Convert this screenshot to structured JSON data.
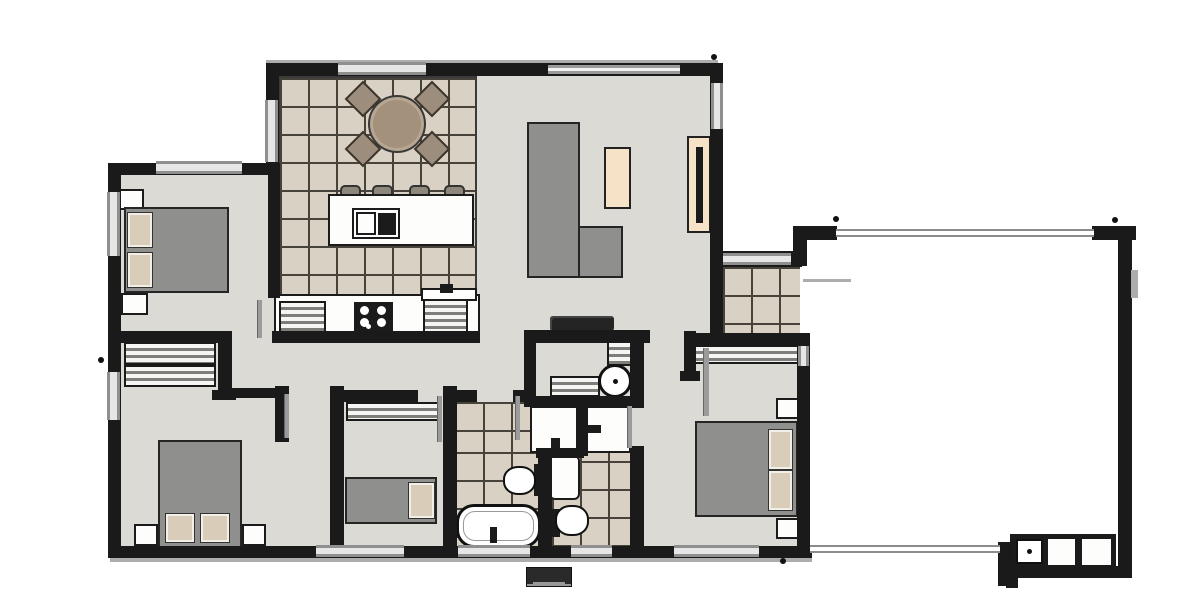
{
  "meta": {
    "title": "house-floor-plan",
    "canvas": {
      "width": 1200,
      "height": 597
    }
  },
  "palette": {
    "wall": "#1a1a1a",
    "floor": "#dbdad5",
    "tile": "#d8d1c4",
    "tileline": "#47423a",
    "furn": "#8f8f8d",
    "pillow": "#d9cdb9",
    "cream": "#f6e2c7",
    "chair": "#9d8d7d",
    "table": "#a3917c"
  },
  "elements": [
    {
      "t": "floor",
      "n": "living-kitchen-floor",
      "x": 276,
      "y": 74,
      "w": 436,
      "h": 262
    },
    {
      "t": "floor",
      "n": "bedroom1-floor",
      "x": 116,
      "y": 170,
      "w": 160,
      "h": 168
    },
    {
      "t": "floor",
      "n": "south-wing-floor",
      "x": 116,
      "y": 336,
      "w": 692,
      "h": 216
    },
    {
      "t": "tile",
      "n": "kitchen-dining-tiles",
      "x": 278,
      "y": 76,
      "w": 199,
      "h": 222,
      "c": "edge"
    },
    {
      "t": "tile",
      "n": "entry-porch-tiles",
      "x": 723,
      "y": 267,
      "w": 77,
      "h": 68
    },
    {
      "t": "tile",
      "n": "bathroom-tiles-upper",
      "x": 455,
      "y": 402,
      "w": 123,
      "h": 50
    },
    {
      "t": "tile",
      "n": "bathroom-tiles-lower",
      "x": 455,
      "y": 452,
      "w": 85,
      "h": 96
    },
    {
      "t": "tile",
      "n": "ensuite-tiles",
      "x": 552,
      "y": 405,
      "w": 80,
      "h": 143
    },
    {
      "t": "gray-line",
      "n": "eave-line-top",
      "x": 266,
      "y": 60,
      "w": 452,
      "h": 3
    },
    {
      "t": "white-box",
      "n": "bed1-nightstand-top",
      "x": 119,
      "y": 189,
      "w": 25,
      "h": 21
    },
    {
      "t": "white-box",
      "n": "bed1-nightstand-bottom",
      "x": 121,
      "y": 293,
      "w": 27,
      "h": 22
    },
    {
      "t": "furn",
      "n": "bed1-bed",
      "x": 124,
      "y": 207,
      "w": 105,
      "h": 86
    },
    {
      "t": "pillow",
      "n": "bed1-pillow-1",
      "x": 128,
      "y": 213,
      "w": 24,
      "h": 34
    },
    {
      "t": "pillow",
      "n": "bed1-pillow-2",
      "x": 128,
      "y": 253,
      "w": 24,
      "h": 34
    },
    {
      "t": "robe",
      "n": "hall-robe-upper",
      "x": 124,
      "y": 342,
      "w": 92,
      "h": 23
    },
    {
      "t": "robe",
      "n": "hall-robe-lower",
      "x": 124,
      "y": 365,
      "w": 92,
      "h": 22
    },
    {
      "t": "furn",
      "n": "bed2-bed",
      "x": 158,
      "y": 440,
      "w": 84,
      "h": 108
    },
    {
      "t": "pillow",
      "n": "bed2-pillow-1",
      "x": 166,
      "y": 514,
      "w": 28,
      "h": 28
    },
    {
      "t": "pillow",
      "n": "bed2-pillow-2",
      "x": 201,
      "y": 514,
      "w": 28,
      "h": 28
    },
    {
      "t": "white-box",
      "n": "bed2-nightstand-left",
      "x": 134,
      "y": 524,
      "w": 24,
      "h": 22
    },
    {
      "t": "white-box",
      "n": "bed2-nightstand-right",
      "x": 242,
      "y": 524,
      "w": 24,
      "h": 22
    },
    {
      "t": "robe",
      "n": "bed3-robe",
      "x": 346,
      "y": 402,
      "w": 96,
      "h": 19
    },
    {
      "t": "furn",
      "n": "bed3-bed",
      "x": 345,
      "y": 477,
      "w": 92,
      "h": 47
    },
    {
      "t": "pillow",
      "n": "bed3-pillow",
      "x": 409,
      "y": 483,
      "w": 25,
      "h": 35
    },
    {
      "t": "robe",
      "n": "master-robe",
      "x": 694,
      "y": 345,
      "w": 108,
      "h": 19
    },
    {
      "t": "white-box",
      "n": "master-nightstand-top",
      "x": 776,
      "y": 398,
      "w": 25,
      "h": 21
    },
    {
      "t": "white-box",
      "n": "master-nightstand-bottom",
      "x": 776,
      "y": 518,
      "w": 25,
      "h": 21
    },
    {
      "t": "furn",
      "n": "master-bed",
      "x": 695,
      "y": 421,
      "w": 103,
      "h": 96
    },
    {
      "t": "pillow",
      "n": "master-pillow-1",
      "x": 769,
      "y": 430,
      "w": 23,
      "h": 39
    },
    {
      "t": "pillow",
      "n": "master-pillow-2",
      "x": 769,
      "y": 471,
      "w": 23,
      "h": 39
    },
    {
      "t": "furn",
      "n": "sofa-main",
      "x": 527,
      "y": 122,
      "w": 53,
      "h": 156
    },
    {
      "t": "furn",
      "n": "sofa-chaise",
      "x": 578,
      "y": 226,
      "w": 45,
      "h": 52
    },
    {
      "t": "cream",
      "n": "coffee-table",
      "x": 604,
      "y": 147,
      "w": 27,
      "h": 62
    },
    {
      "t": "cream",
      "n": "tv-cabinet",
      "x": 687,
      "y": 136,
      "w": 24,
      "h": 97
    },
    {
      "t": "dark-box",
      "n": "tv",
      "x": 696,
      "y": 147,
      "w": 7,
      "h": 76
    },
    {
      "t": "white-box",
      "n": "kitchen-counter",
      "x": 274,
      "y": 294,
      "w": 206,
      "h": 44
    },
    {
      "t": "robe",
      "n": "kitchen-cabinet-left",
      "x": 279,
      "y": 301,
      "w": 47,
      "h": 32
    },
    {
      "t": "dark-box",
      "n": "cooktop",
      "x": 354,
      "y": 302,
      "w": 39,
      "h": 31
    },
    {
      "t": "burner",
      "n": "burner-1",
      "x": 360,
      "y": 306,
      "w": 9,
      "h": 9
    },
    {
      "t": "burner",
      "n": "burner-2",
      "x": 377,
      "y": 306,
      "w": 9,
      "h": 9
    },
    {
      "t": "burner",
      "n": "burner-3",
      "x": 360,
      "y": 318,
      "w": 9,
      "h": 9
    },
    {
      "t": "burner",
      "n": "burner-4",
      "x": 377,
      "y": 318,
      "w": 9,
      "h": 9
    },
    {
      "t": "burner",
      "n": "burner-5",
      "x": 366,
      "y": 324,
      "w": 5,
      "h": 5
    },
    {
      "t": "robe",
      "n": "kitchen-cabinet-right",
      "x": 423,
      "y": 299,
      "w": 45,
      "h": 34
    },
    {
      "t": "white-box",
      "n": "kitchen-sink-bench",
      "x": 421,
      "y": 288,
      "w": 56,
      "h": 13
    },
    {
      "t": "dark-box",
      "n": "kitchen-tap",
      "x": 440,
      "y": 284,
      "w": 13,
      "h": 9
    },
    {
      "t": "stool",
      "n": "stool-1",
      "x": 340,
      "y": 185,
      "w": 21,
      "h": 13
    },
    {
      "t": "stool",
      "n": "stool-2",
      "x": 372,
      "y": 185,
      "w": 21,
      "h": 13
    },
    {
      "t": "stool",
      "n": "stool-3",
      "x": 409,
      "y": 185,
      "w": 21,
      "h": 13
    },
    {
      "t": "stool",
      "n": "stool-4",
      "x": 444,
      "y": 185,
      "w": 21,
      "h": 13
    },
    {
      "t": "white-box",
      "n": "island-bench",
      "x": 328,
      "y": 194,
      "w": 146,
      "h": 52
    },
    {
      "t": "white-box",
      "n": "island-sink",
      "x": 352,
      "y": 208,
      "w": 48,
      "h": 31
    },
    {
      "t": "white-box",
      "n": "island-sink-basin",
      "x": 356,
      "y": 212,
      "w": 20,
      "h": 23
    },
    {
      "t": "dark-box",
      "n": "island-sink-drainer",
      "x": 378,
      "y": 213,
      "w": 18,
      "h": 22
    },
    {
      "t": "chair",
      "n": "dining-chair-nw",
      "x": 350,
      "y": 86,
      "w": 26,
      "h": 26
    },
    {
      "t": "chair",
      "n": "dining-chair-ne",
      "x": 419,
      "y": 86,
      "w": 26,
      "h": 26
    },
    {
      "t": "chair",
      "n": "dining-chair-sw",
      "x": 350,
      "y": 136,
      "w": 26,
      "h": 26
    },
    {
      "t": "chair",
      "n": "dining-chair-se",
      "x": 419,
      "y": 136,
      "w": 26,
      "h": 26
    },
    {
      "t": "table-round",
      "n": "dining-table",
      "x": 368,
      "y": 95,
      "w": 58,
      "h": 58
    },
    {
      "t": "benchdark",
      "n": "laundry-appliance",
      "x": 550,
      "y": 316,
      "w": 64,
      "h": 15
    },
    {
      "t": "robe",
      "n": "laundry-shelf",
      "x": 550,
      "y": 376,
      "w": 50,
      "h": 21
    },
    {
      "t": "robe",
      "n": "laundry-pantry",
      "x": 607,
      "y": 341,
      "w": 25,
      "h": 25
    },
    {
      "t": "washer",
      "n": "washing-machine",
      "x": 598,
      "y": 364,
      "w": 34,
      "h": 34
    },
    {
      "t": "white-box",
      "n": "bath-vanity",
      "x": 530,
      "y": 406,
      "w": 49,
      "h": 47
    },
    {
      "t": "dark-box",
      "n": "bath-vanity-tap",
      "x": 551,
      "y": 438,
      "w": 9,
      "h": 13
    },
    {
      "t": "dark-box",
      "n": "bath-toilet-tank",
      "x": 534,
      "y": 464,
      "w": 14,
      "h": 32
    },
    {
      "t": "toilet",
      "n": "bath-toilet",
      "x": 503,
      "y": 466,
      "w": 33,
      "h": 29
    },
    {
      "t": "tub",
      "n": "bathtub",
      "x": 456,
      "y": 504,
      "w": 85,
      "h": 44
    },
    {
      "t": "dark-box",
      "n": "bathtub-tap",
      "x": 490,
      "y": 527,
      "w": 7,
      "h": 16
    },
    {
      "t": "white-box",
      "n": "ensuite-vanity",
      "x": 584,
      "y": 406,
      "w": 47,
      "h": 47
    },
    {
      "t": "dark-box",
      "n": "ensuite-vanity-tap",
      "x": 586,
      "y": 425,
      "w": 15,
      "h": 8
    },
    {
      "t": "white-box",
      "n": "shower",
      "x": 549,
      "y": 455,
      "w": 31,
      "h": 45,
      "c": "rnd"
    },
    {
      "t": "dark-box",
      "n": "shower-fixture",
      "x": 541,
      "y": 470,
      "w": 8,
      "h": 16
    },
    {
      "t": "dark-box",
      "n": "ensuite-toilet-tank",
      "x": 548,
      "y": 509,
      "w": 12,
      "h": 28
    },
    {
      "t": "toilet",
      "n": "ensuite-toilet",
      "x": 555,
      "y": 505,
      "w": 34,
      "h": 31
    },
    {
      "t": "dark-box",
      "n": "garage-bench-base",
      "x": 1010,
      "y": 534,
      "w": 106,
      "h": 36
    },
    {
      "t": "sinkbox",
      "n": "garage-sink",
      "x": 1016,
      "y": 539,
      "w": 27,
      "h": 25
    },
    {
      "t": "white-box",
      "n": "garage-bench-1",
      "x": 1046,
      "y": 537,
      "w": 31,
      "h": 30
    },
    {
      "t": "white-box",
      "n": "garage-bench-2",
      "x": 1080,
      "y": 537,
      "w": 33,
      "h": 30
    },
    {
      "t": "meter",
      "n": "meter-box",
      "x": 526,
      "y": 567,
      "w": 46,
      "h": 20
    },
    {
      "t": "wall",
      "n": "wall-dining-top",
      "x": 266,
      "y": 63,
      "w": 212,
      "h": 13
    },
    {
      "t": "wall",
      "n": "wall-dining-left",
      "x": 266,
      "y": 63,
      "w": 13,
      "h": 110
    },
    {
      "t": "wall",
      "n": "wall-bed1-top",
      "x": 108,
      "y": 163,
      "w": 172,
      "h": 12
    },
    {
      "t": "wall",
      "n": "wall-exterior-left",
      "x": 108,
      "y": 163,
      "w": 13,
      "h": 395
    },
    {
      "t": "wall",
      "n": "wall-exterior-bottom",
      "x": 108,
      "y": 546,
      "w": 704,
      "h": 12
    },
    {
      "t": "wall",
      "n": "wall-master-east",
      "x": 797,
      "y": 335,
      "w": 13,
      "h": 223
    },
    {
      "t": "wall",
      "n": "wall-master-top",
      "x": 686,
      "y": 333,
      "w": 124,
      "h": 13
    },
    {
      "t": "wall",
      "n": "wall-living-right",
      "x": 710,
      "y": 63,
      "w": 13,
      "h": 279
    },
    {
      "t": "wall",
      "n": "wall-entry",
      "x": 710,
      "y": 251,
      "w": 92,
      "h": 16
    },
    {
      "t": "wall",
      "n": "wall-living-top",
      "x": 476,
      "y": 63,
      "w": 246,
      "h": 13
    },
    {
      "t": "wall",
      "n": "wall-bed1-east",
      "x": 268,
      "y": 173,
      "w": 12,
      "h": 125
    },
    {
      "t": "wall",
      "n": "wall-bed1-bottom",
      "x": 116,
      "y": 331,
      "w": 116,
      "h": 12
    },
    {
      "t": "wall",
      "n": "wall-nook-east",
      "x": 218,
      "y": 331,
      "w": 14,
      "h": 63
    },
    {
      "t": "wall",
      "n": "wall-nook-cap",
      "x": 212,
      "y": 390,
      "w": 24,
      "h": 10
    },
    {
      "t": "wall",
      "n": "wall-kitchen-bottom",
      "x": 272,
      "y": 331,
      "w": 208,
      "h": 12
    },
    {
      "t": "wall",
      "n": "wall-bed2-top",
      "x": 232,
      "y": 388,
      "w": 57,
      "h": 10
    },
    {
      "t": "wall",
      "n": "wall-bed2-stub",
      "x": 275,
      "y": 386,
      "w": 14,
      "h": 56
    },
    {
      "t": "wall",
      "n": "wall-bed3-west",
      "x": 330,
      "y": 386,
      "w": 14,
      "h": 166
    },
    {
      "t": "wall",
      "n": "wall-bed3-north",
      "x": 330,
      "y": 390,
      "w": 88,
      "h": 12
    },
    {
      "t": "wall",
      "n": "wall-bed3-east",
      "x": 443,
      "y": 386,
      "w": 14,
      "h": 166
    },
    {
      "t": "wall",
      "n": "wall-bath-north-left",
      "x": 455,
      "y": 390,
      "w": 22,
      "h": 12
    },
    {
      "t": "wall",
      "n": "wall-bath-north-right",
      "x": 513,
      "y": 390,
      "w": 23,
      "h": 12
    },
    {
      "t": "wall",
      "n": "wall-hall-laundry",
      "x": 524,
      "y": 330,
      "w": 12,
      "h": 74
    },
    {
      "t": "wall",
      "n": "wall-living-bottom",
      "x": 524,
      "y": 330,
      "w": 126,
      "h": 13
    },
    {
      "t": "wall",
      "n": "wall-laundry-south",
      "x": 524,
      "y": 396,
      "w": 120,
      "h": 11
    },
    {
      "t": "wall",
      "n": "wall-vanity-divider",
      "x": 576,
      "y": 398,
      "w": 12,
      "h": 58
    },
    {
      "t": "wall",
      "n": "wall-bath-mid",
      "x": 536,
      "y": 448,
      "w": 48,
      "h": 10
    },
    {
      "t": "wall",
      "n": "wall-bath-ensuite",
      "x": 538,
      "y": 452,
      "w": 14,
      "h": 96
    },
    {
      "t": "wall",
      "n": "wall-ensuite-east-upper",
      "x": 630,
      "y": 330,
      "w": 14,
      "h": 78
    },
    {
      "t": "wall",
      "n": "wall-ensuite-east-lower",
      "x": 630,
      "y": 446,
      "w": 14,
      "h": 106
    },
    {
      "t": "wall",
      "n": "wall-master-stub",
      "x": 684,
      "y": 331,
      "w": 12,
      "h": 48
    },
    {
      "t": "wall",
      "n": "cap-master-stub",
      "x": 680,
      "y": 371,
      "w": 20,
      "h": 10
    },
    {
      "t": "wall",
      "n": "garage-post-nw-a",
      "x": 793,
      "y": 226,
      "w": 44,
      "h": 14
    },
    {
      "t": "wall",
      "n": "garage-post-nw-b",
      "x": 793,
      "y": 226,
      "w": 14,
      "h": 40
    },
    {
      "t": "wall",
      "n": "garage-post-ne",
      "x": 1092,
      "y": 226,
      "w": 44,
      "h": 14
    },
    {
      "t": "wall",
      "n": "wall-garage-right",
      "x": 1118,
      "y": 226,
      "w": 14,
      "h": 352
    },
    {
      "t": "wall",
      "n": "wall-garage-bottom",
      "x": 1000,
      "y": 566,
      "w": 132,
      "h": 12
    },
    {
      "t": "wall",
      "n": "garage-door-post",
      "x": 998,
      "y": 542,
      "w": 14,
      "h": 44
    },
    {
      "t": "wall",
      "n": "garage-notch",
      "x": 1006,
      "y": 578,
      "w": 12,
      "h": 10
    },
    {
      "t": "window",
      "n": "window-dining-top",
      "x": 338,
      "y": 62,
      "w": 88,
      "h": 13
    },
    {
      "t": "window",
      "n": "window-dining-left",
      "x": 265,
      "y": 100,
      "w": 13,
      "h": 62,
      "c": "v"
    },
    {
      "t": "window",
      "n": "window-bed1-top",
      "x": 156,
      "y": 161,
      "w": 86,
      "h": 13
    },
    {
      "t": "window",
      "n": "window-bed1-left",
      "x": 107,
      "y": 192,
      "w": 13,
      "h": 64,
      "c": "v"
    },
    {
      "t": "window",
      "n": "window-bed2-left",
      "x": 107,
      "y": 372,
      "w": 13,
      "h": 48,
      "c": "v"
    },
    {
      "t": "window",
      "n": "window-bed3-bottom",
      "x": 316,
      "y": 545,
      "w": 88,
      "h": 12
    },
    {
      "t": "window",
      "n": "window-bath-bottom",
      "x": 458,
      "y": 545,
      "w": 72,
      "h": 12
    },
    {
      "t": "window",
      "n": "window-ensuite-bottom",
      "x": 571,
      "y": 545,
      "w": 41,
      "h": 12
    },
    {
      "t": "window",
      "n": "window-master-bottom",
      "x": 674,
      "y": 545,
      "w": 85,
      "h": 12
    },
    {
      "t": "window",
      "n": "window-living-right",
      "x": 711,
      "y": 83,
      "w": 12,
      "h": 46,
      "c": "v"
    },
    {
      "t": "window",
      "n": "window-master-east",
      "x": 798,
      "y": 346,
      "w": 11,
      "h": 20,
      "c": "v"
    },
    {
      "t": "glz",
      "n": "glazing-living-top",
      "x": 548,
      "y": 65,
      "w": 132,
      "h": 9
    },
    {
      "t": "window",
      "n": "entry-door",
      "x": 723,
      "y": 253,
      "w": 68,
      "h": 12
    },
    {
      "t": "dline",
      "n": "garage-roof-line",
      "x": 836,
      "y": 229,
      "w": 258,
      "h": 8
    },
    {
      "t": "dline",
      "n": "garage-door-track",
      "x": 810,
      "y": 545,
      "w": 190,
      "h": 8
    },
    {
      "t": "gray-line",
      "n": "garage-eave-line",
      "x": 803,
      "y": 279,
      "w": 48,
      "h": 3
    },
    {
      "t": "gray-line",
      "n": "garage-meter-bump",
      "x": 1131,
      "y": 270,
      "w": 7,
      "h": 28
    },
    {
      "t": "leaf",
      "n": "door-leaf-bed1",
      "x": 257,
      "y": 300,
      "w": 5,
      "h": 38
    },
    {
      "t": "leaf",
      "n": "door-leaf-bed2",
      "x": 284,
      "y": 394,
      "w": 5,
      "h": 44
    },
    {
      "t": "leaf",
      "n": "door-leaf-bed3",
      "x": 437,
      "y": 396,
      "w": 5,
      "h": 46
    },
    {
      "t": "leaf",
      "n": "door-leaf-bath",
      "x": 515,
      "y": 396,
      "w": 5,
      "h": 44
    },
    {
      "t": "leaf",
      "n": "door-leaf-ensuite",
      "x": 627,
      "y": 406,
      "w": 5,
      "h": 42
    },
    {
      "t": "leaf",
      "n": "door-leaf-master",
      "x": 703,
      "y": 348,
      "w": 6,
      "h": 68
    },
    {
      "t": "gray-line",
      "n": "shadow-bottom",
      "x": 110,
      "y": 558,
      "w": 702,
      "h": 4
    },
    {
      "t": "dot",
      "n": "marker-dot-1",
      "x": 711,
      "y": 54,
      "w": 6,
      "h": 6
    },
    {
      "t": "dot",
      "n": "marker-dot-2",
      "x": 833,
      "y": 216,
      "w": 6,
      "h": 6
    },
    {
      "t": "dot",
      "n": "marker-dot-3",
      "x": 1112,
      "y": 217,
      "w": 6,
      "h": 6
    },
    {
      "t": "dot",
      "n": "marker-dot-4",
      "x": 780,
      "y": 558,
      "w": 6,
      "h": 6
    },
    {
      "t": "dot",
      "n": "marker-dot-5",
      "x": 98,
      "y": 357,
      "w": 6,
      "h": 6
    }
  ]
}
